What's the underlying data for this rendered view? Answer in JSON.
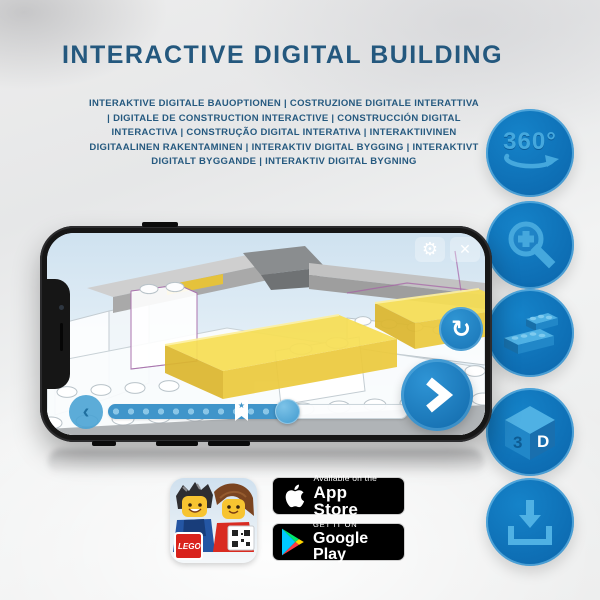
{
  "title": "INTERACTIVE DIGITAL BUILDING",
  "subtitle": "INTERAKTIVE DIGITALE BAUOPTIONEN | COSTRUZIONE DIGITALE INTERATTIVA | DIGITALE DE CONSTRUCTION INTERACTIVE | CONSTRUCCIÓN DIGITAL INTERACTIVA | CONSTRUÇÃO DIGITAL INTERATIVA | INTERAKTIIVINEN DIGITAALINEN RAKENTAMINEN | INTERAKTIV DIGITAL BYGGING | INTERAKTIVT DIGITALT BYGGANDE | INTERAKTIV DIGITAL BYGNING",
  "colors": {
    "title_blue": "#24587e",
    "circle_blue": "#0d6cb2",
    "glyph_blue": "#45a8dd",
    "brick_yellow": "#f6dd4e",
    "phone_black": "#161616"
  },
  "feature_icons": {
    "rotation_label": "360°",
    "cube_label_left": "3",
    "cube_label_right": "D"
  },
  "phone_ui": {
    "settings_glyph": "⚙",
    "close_glyph": "✕",
    "rotate_glyph": "↻",
    "back_glyph": "‹",
    "star_glyph": "★"
  },
  "badges": {
    "app_store": {
      "line1": "Available on the",
      "line2": "App Store"
    },
    "google_play": {
      "line1": "GET IT ON",
      "line2": "Google Play"
    }
  },
  "app_icon": {
    "lego_logo": "LEGO"
  }
}
